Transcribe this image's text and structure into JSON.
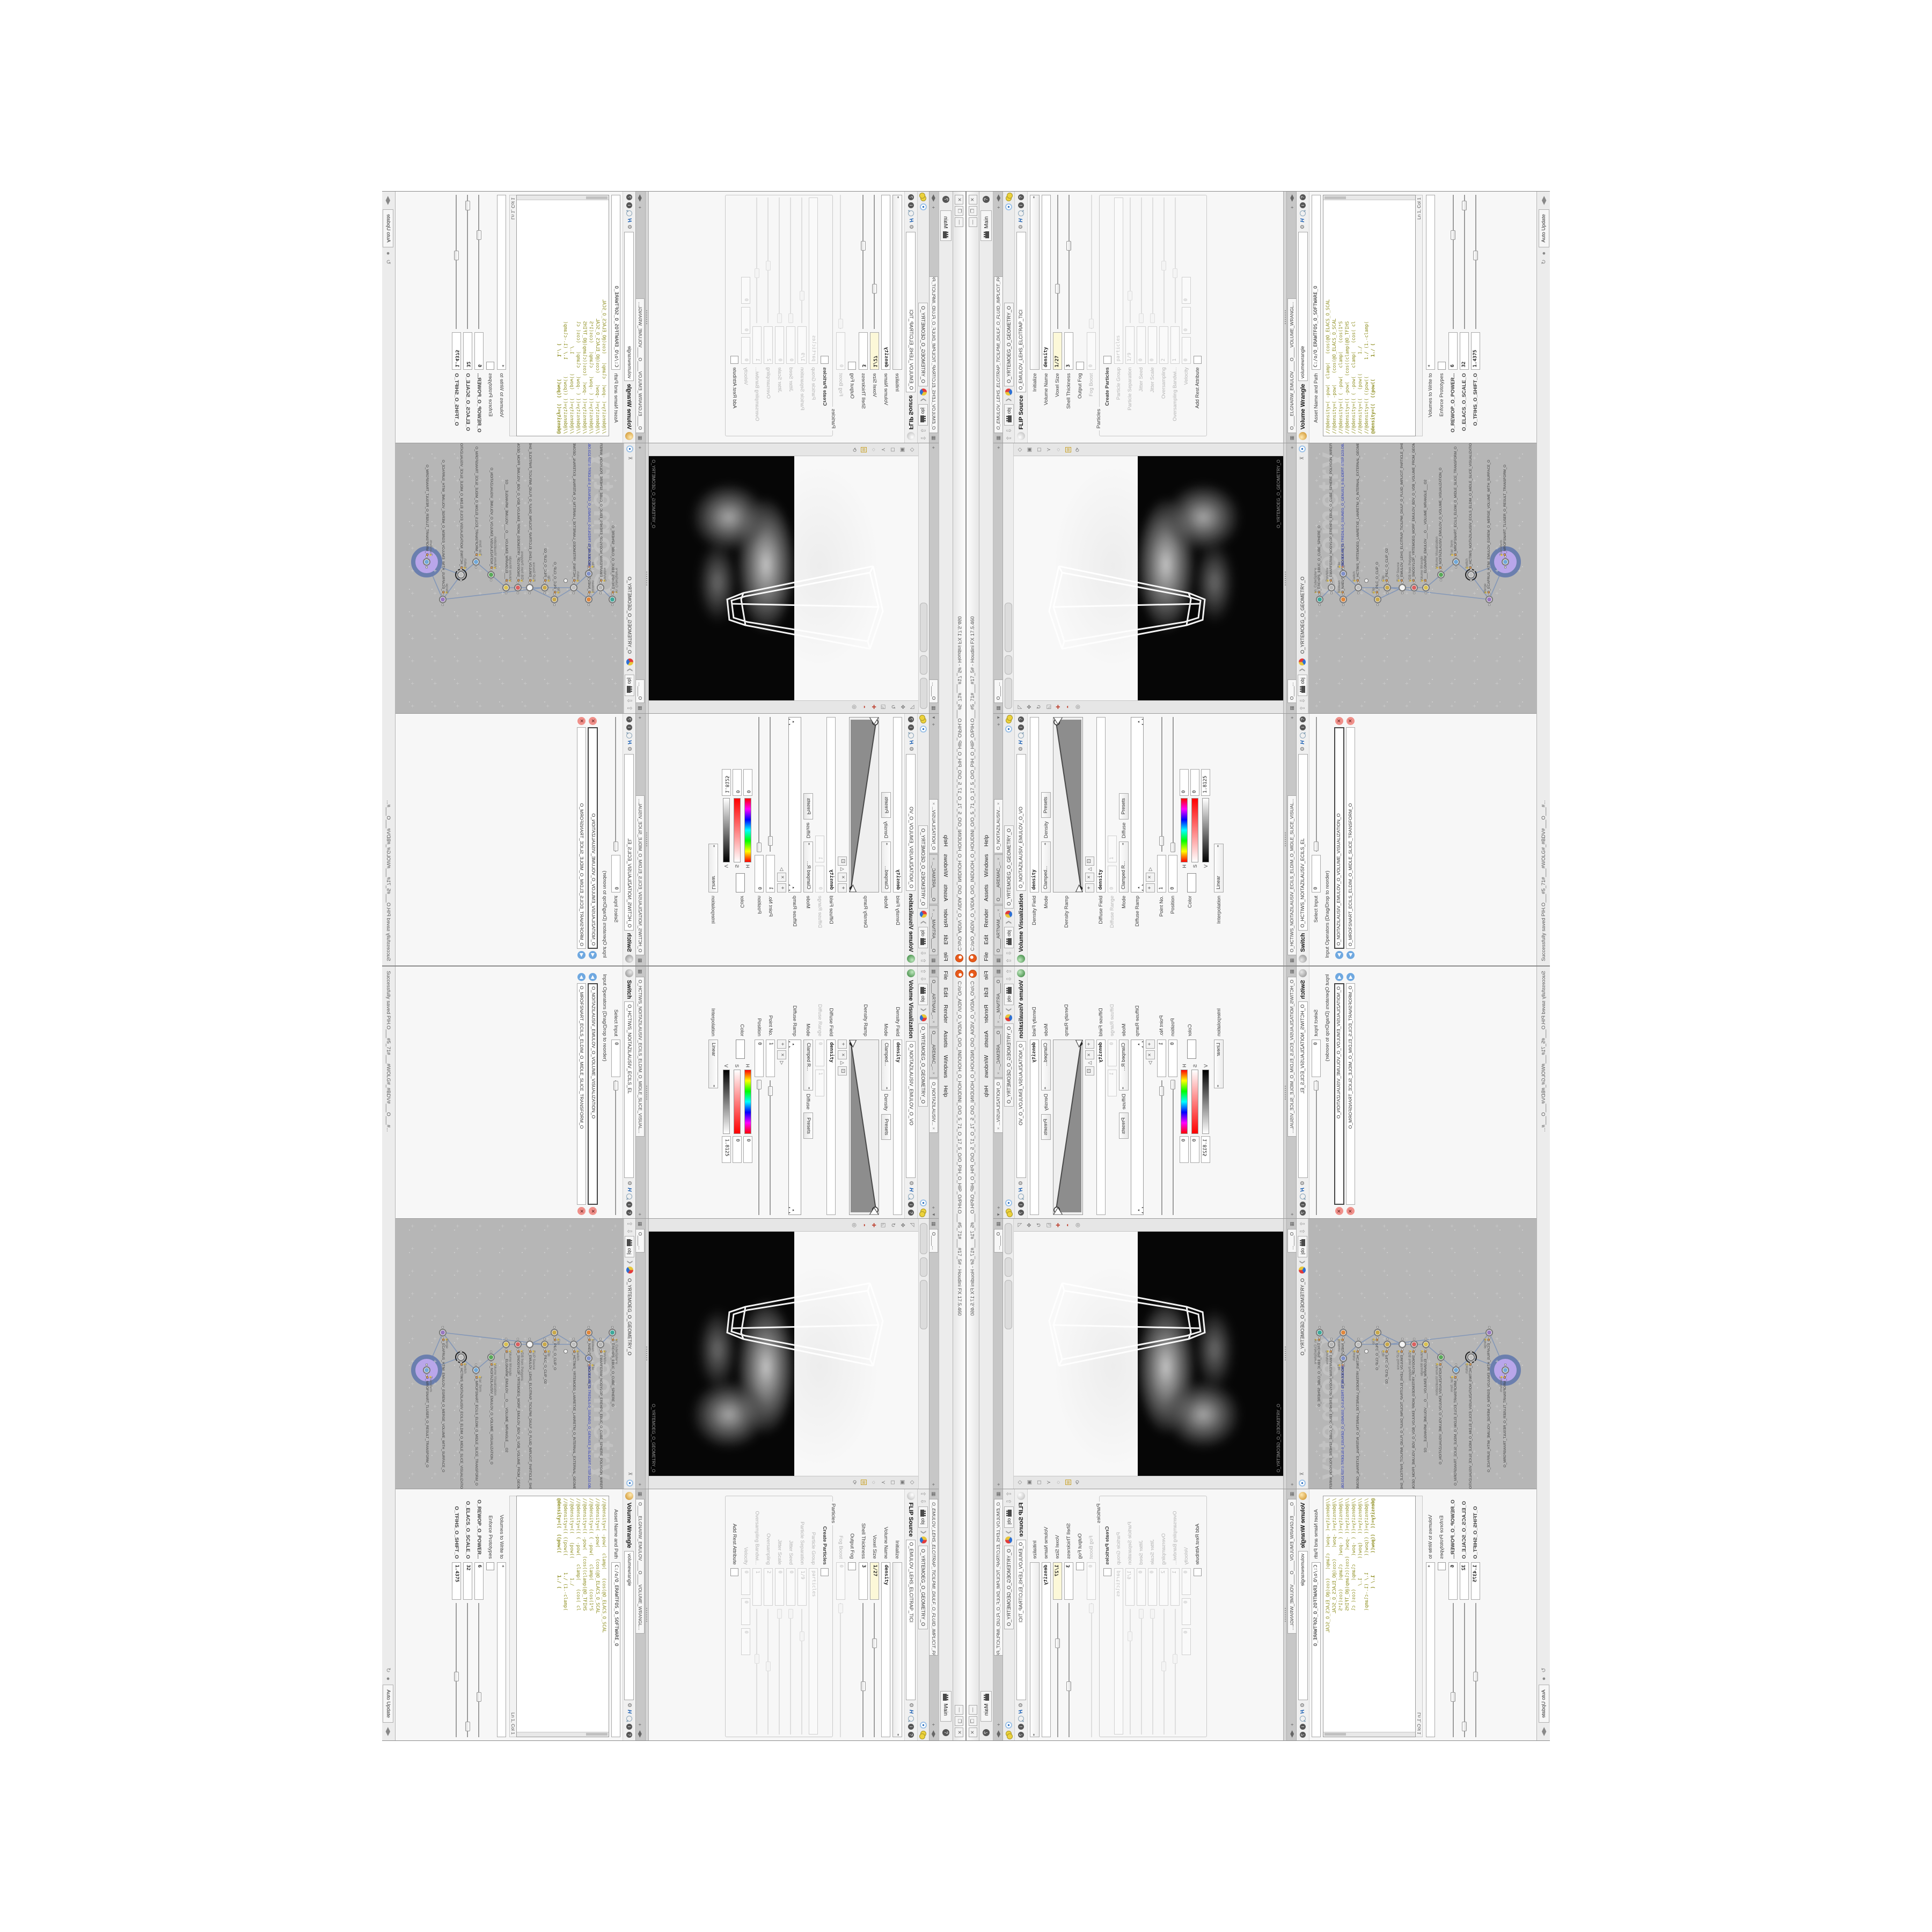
{
  "app": {
    "title": "C:/o/O_AIDIV_O_VIDIA_O/O_INIDUOH_O_HOUDINI_O/O_5_71_O_17_5_O/O_PIH_O_HIP_O/PIH.O___#5_71#___#17_5#  -  Houdini FX  17.5.460",
    "window_minimize": "—",
    "window_maximize": "❐",
    "window_close": "✕"
  },
  "menu": {
    "items": [
      "File",
      "Edit",
      "Render",
      "Assets",
      "Windows",
      "Help"
    ],
    "desktop_label": "Main",
    "help_badge": "?"
  },
  "left_column": {
    "tabs": [
      {
        "label": "O____ARTNAM_...",
        "close": "×"
      },
      {
        "label": "O____AREMAC_...",
        "close": "×"
      },
      {
        "label": "O_NOITAZILAUSIV...",
        "close": "×"
      }
    ],
    "viz": {
      "breadcrumb_root": "obj",
      "breadcrumb_chev": "❯",
      "path_chip": "O_YRTEMOEG_O_GEOMETRY_O",
      "title": "Volume Visualization",
      "name_value": "O_NOITAZILAUSIV_EMULOV_O_VO",
      "density_field_label": "Density Field",
      "density_field_value": "density",
      "mode_label": "Mode",
      "mode_value": "Clamped...",
      "mode_target": "Density",
      "presets_label": "Presets",
      "density_ramp_label": "Density Ramp",
      "diffuse_field_label": "Diffuse Field",
      "diffuse_field_value": "density",
      "diffuse_range_label": "Diffuse Range",
      "diffuse_range_min": "0",
      "diffuse_range_max": "1",
      "mode2_value": "Clamped R...",
      "mode2_target": "Diffuse",
      "diffuse_ramp_label": "Diffuse Ramp",
      "point_no_label": "Point No.",
      "point_no_value": "1",
      "position_label": "Position",
      "position_value": "0",
      "color_label": "Color",
      "hsv": {
        "h_label": "H",
        "h_value": "0",
        "s_label": "S",
        "s_value": "0",
        "v_label": "V",
        "v_value": "1.8125"
      },
      "interpolation_label": "Interpolation",
      "interpolation_value": "Linear"
    },
    "switch": {
      "tab": "O_HCTIWS_NOITAZILAUSIV_ECILS_ELDIM_O_MIDLE_SLICE_VISUAL...",
      "title": "Switch",
      "name_value": "O_HCTIWS_NOITAZILAUSIV_ECILS_EL",
      "select_input_label": "Select Input",
      "select_input_value": "0",
      "list_header": "Input Operators (Drag/Drop to reorder)",
      "rows": [
        {
          "text": "O_NOITAZILAUSIV_EMULOV_O_VOLUME_VISUALIZATION_O"
        },
        {
          "text": "O_MROFSNART_ECILS_ELDIM_O_MIDLE_SLICE_TRANSFORM_O"
        }
      ]
    }
  },
  "middle_column": {
    "viewport": {
      "tab": "O____...",
      "corner_label": "O_YRTEMOEG_O_GEOMETRY_O"
    },
    "network": {
      "tab": "O____...",
      "breadcrumb_root": "obj",
      "path_chip": "O_YRTEMOEG_O_GEOMETRY_O",
      "watermark": "Geometry",
      "nodes": [
        {
          "name": "an_CubeSphere",
          "long": "O_EREHPS_EBUC_O_CUBE_SPHERE_O",
          "color": "#3da89a"
        },
        {
          "name": "PolyWire",
          "long": "O_EMARFERIW_NOGYLOP_EREHPS_EBUC_O_CUBE_SPHERE_POLYGON_WIREFRAME_O",
          "color": "#b8b8b8"
        },
        {
          "name": "Boolean",
          "long": "O_NAELOOB_O_BOOLEAN_O",
          "color": "#e0873c"
        },
        {
          "name": "File",
          "long": "JBO.3D1.PETS-TREDILS-0_SSUNEG_O_GENUS3_0-SLIDERT-STEP.1D3.OBJ",
          "color": "#8090c8"
        },
        {
          "name": "Switch",
          "long": "O_HCTIWS_YRTEMOEG_LANRETXE_LANRETNI_O_INTERNAL_EXTERNAL_GEOMETRY_SW...",
          "color": "#c0c0c0"
        },
        {
          "name": "Clip",
          "long": "O_PILC_O_CLIP_O",
          "color": "#c8a84a"
        },
        {
          "name": "Clip",
          "long": "O_PILC_O_CLIP_O2",
          "color": "#c8a84a"
        },
        {
          "name": "FLIP Source",
          "long": "O_EMULOV_LEHS_ELCITRAP_TICILPMI_DIULF_O_FLUID_IMPLICIT_PARTICLE_SHEL...",
          "color": "#f4f4f4"
        },
        {
          "name": "VDB from Polygons",
          "long": "O_SNOGYLOP_YRTEMOEG_MORF_EMULOV_BDV_O_VDB_VOLUME_FROM_GEOMETR...",
          "color": "#d86060"
        },
        {
          "name": "Volume Wrangle",
          "long": "O___ELGNARW_EMULOV___O___VOLUME_WRANGLE___O2",
          "color": "#d8c050"
        },
        {
          "name": "Volume Visualization",
          "long": "O_NOITAZILAUSIV_EMULOV_O_VOLUME_VISUALIZATION_O",
          "color": "#58a858"
        },
        {
          "name": "Transform",
          "long": "O_MROFSNART_ECILS_ELDIM_O_MIDLE_SLICE_TRANSFORM_O",
          "color": "#70a8d8"
        },
        {
          "name": "Switch",
          "long": "O_HCTIWS_NOITAZILAUSIV_ECILS_ELDIM_O_MIDLE_SLICE_VISUALIZATION_SWITC...",
          "color": "#c0c0c0"
        },
        {
          "name": "Merge",
          "long": "O_ECAFRUS_HTIW_EMULOV_EGREM_O_MERGE_VOLUME_WITH_SURFACE_O",
          "color": "#9878c0"
        },
        {
          "name": "Transform",
          "long": "O_MROFSNART_TLUSER_O_RESULT_TRANSFORM_O",
          "color": "#70a8d8"
        }
      ]
    }
  },
  "right_column": {
    "flip": {
      "tab": "O_EMULOV_LEHS_ELCITRAP_TICILPMI_DIULF_O_FLUID_IMPLICIT_PARTI...",
      "breadcrumb_root": "obj",
      "path_chip": "O_YRTEMOEG_O_GEOMETRY_O",
      "title": "FLIP Source",
      "name_value": "O_EMULOV_LEHS_ELCITRAP_TICI",
      "initialize_label": "Initialize",
      "volume_name_label": "Volume Name",
      "volume_name_value": "density",
      "voxel_size_label": "Voxel Size",
      "voxel_size_value": "1/27",
      "shell_label": "Shell Thickness",
      "shell_value": "3",
      "output_fog_label": "Output Fog",
      "fog_boost_label": "Fog Boost",
      "fog_boost_value": "0",
      "particles_group_label": "Particles",
      "create_particles_label": "Create Particles",
      "particle_group_label": "Particle Group",
      "particle_group_value": "particles",
      "particle_sep_label": "Particle Separation",
      "particle_sep_value": "1/9",
      "jitter_seed_label": "Jitter Seed",
      "jitter_seed_value": "0",
      "jitter_scale_label": "Jitter Scale",
      "jitter_scale_value": "0",
      "oversampling_label": "Oversampling",
      "oversampling_value": "2",
      "oversampling_bw_label": "Oversampling Bandwi...",
      "oversampling_bw_value": "1",
      "velocity_label": "Velocity",
      "velocity_x": "0",
      "velocity_y": "0",
      "velocity_z": "0",
      "add_rest_label": "Add Rest Attribute"
    },
    "wrangle": {
      "tab": "O____ELGNARW_EMULOV____O____VOLUME_WRANGL...",
      "title": "Volume Wrangle",
      "name_value": "volumewrangle",
      "asset_label": "Asset Name and Path",
      "asset_value": "C:/o/O_ERAWTFOS_O_SOFTWARE_O",
      "code_lines": [
        "//@density=( -pow(  clamp(   (cos(@O_ELACS_O_SCAL",
        "//@density=( -pow(    (cos(@O_ELACS_O_SCAL",
        "//@density=(( ( -pow(   clamp(   (cos(1*S",
        "//@density=(( -pow(  (cos((clamp(@O_TFIHS",
        "//@density=(( ( -pow(   clamp(   (cos( cl",
        "//@density=((   (pow((       1./",
        "//@density=(( ((pow((      1./ (1.-clamp(",
        "@density=((  ((pow((        1./ ("
      ],
      "code_footer": "Ln 1, Col 1",
      "volumes_label": "Volumes to Write to",
      "volumes_value": "*",
      "enforce_label": "Enforce Prototypes",
      "sliders": [
        {
          "label": "O_REWOP_O_POWER...",
          "value": "6"
        },
        {
          "label": "O_ELACS_O_SCALE_O",
          "value": "32"
        },
        {
          "label": "O_TFIHS_O_SHIFT_O",
          "value": "1.4375"
        }
      ]
    }
  },
  "status_bar": {
    "message": "Successfully saved PIH.O___#5_71#___#WOLG#_#BDV#___O___#...",
    "auto_update_label": "Auto Update",
    "refresh_icon": "↻"
  }
}
